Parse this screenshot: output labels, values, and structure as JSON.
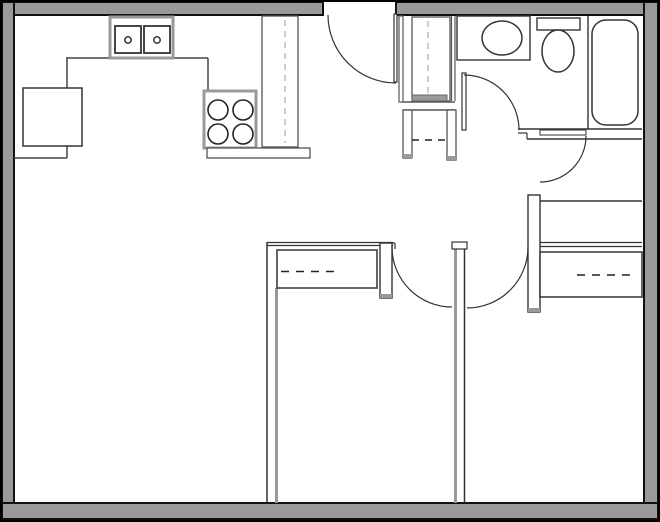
{
  "canvas": {
    "width": 660,
    "height": 522,
    "background": "#ffffff"
  },
  "colors": {
    "wall_fill": "#9a9a9a",
    "wall_edge": "#111111",
    "line_dark": "#2a2a2a",
    "line_mid": "#555555",
    "line_gray": "#999999",
    "dash_light": "#b0b0b0",
    "dash_dark": "#222222",
    "white": "#ffffff"
  },
  "frame": {
    "name": "outer-border",
    "x": 1,
    "y": 1,
    "w": 658,
    "h": 520,
    "stroke": "#000000",
    "sw": 2
  },
  "walls": [
    {
      "name": "wall-top-left-of-entry-door",
      "x": 2,
      "y": 2,
      "w": 321,
      "h": 13
    },
    {
      "name": "wall-top-right-of-entry-door",
      "x": 396,
      "y": 2,
      "w": 262,
      "h": 13
    },
    {
      "name": "wall-left",
      "x": 2,
      "y": 2,
      "w": 12,
      "h": 518
    },
    {
      "name": "wall-right",
      "x": 644,
      "y": 2,
      "w": 14,
      "h": 518
    },
    {
      "name": "wall-bottom",
      "x": 2,
      "y": 503,
      "w": 656,
      "h": 16
    }
  ],
  "lines": [
    {
      "name": "kitchen-counter-left-front-upper",
      "x1": 67,
      "y1": 57,
      "x2": 67,
      "y2": 88,
      "stroke": "#444444",
      "sw": 1.5
    },
    {
      "name": "kitchen-counter-left-front-lower",
      "x1": 67,
      "y1": 146,
      "x2": 67,
      "y2": 158,
      "stroke": "#444444",
      "sw": 1.5
    },
    {
      "name": "kitchen-counter-left-endcap",
      "x1": 14,
      "y1": 158,
      "x2": 67,
      "y2": 158,
      "stroke": "#444444",
      "sw": 1.5
    },
    {
      "name": "kitchen-counter-top-front-a",
      "x1": 67,
      "y1": 58,
      "x2": 110,
      "y2": 58,
      "stroke": "#444444",
      "sw": 1.5
    },
    {
      "name": "kitchen-counter-top-front-b",
      "x1": 173,
      "y1": 58,
      "x2": 208,
      "y2": 58,
      "stroke": "#444444",
      "sw": 1.5
    },
    {
      "name": "kitchen-counter-step",
      "x1": 208,
      "y1": 58,
      "x2": 208,
      "y2": 91,
      "stroke": "#444444",
      "sw": 1.5
    },
    {
      "name": "pantry-cabinet-inner-edge",
      "x1": 266,
      "y1": 16,
      "x2": 266,
      "y2": 147,
      "stroke": "#888888",
      "sw": 1.2
    },
    {
      "name": "entry-closet-inner-left",
      "x1": 416,
      "y1": 17,
      "x2": 416,
      "y2": 95,
      "stroke": "#555555",
      "sw": 1
    },
    {
      "name": "entry-closet-inner-right",
      "x1": 446,
      "y1": 17,
      "x2": 446,
      "y2": 95,
      "stroke": "#555555",
      "sw": 1
    },
    {
      "name": "entry-closet-bottom-line",
      "x1": 403,
      "y1": 102,
      "x2": 455,
      "y2": 102,
      "stroke": "#555555",
      "sw": 1.4
    },
    {
      "name": "hall-closet-top-line",
      "x1": 403,
      "y1": 110,
      "x2": 456,
      "y2": 110,
      "stroke": "#555555",
      "sw": 1.4
    },
    {
      "name": "bathroom-west-wall-a",
      "x1": 451.5,
      "y1": 16,
      "x2": 451.5,
      "y2": 101,
      "stroke": "#555555",
      "sw": 1.2
    },
    {
      "name": "bathroom-west-wall-b",
      "x1": 455,
      "y1": 16,
      "x2": 455,
      "y2": 101,
      "stroke": "#555555",
      "sw": 1.2
    },
    {
      "name": "vanity-divider",
      "x1": 472,
      "y1": 16,
      "x2": 472,
      "y2": 60,
      "stroke": "#333333",
      "sw": 1.3
    },
    {
      "name": "tub-alcove-edge",
      "x1": 588,
      "y1": 16,
      "x2": 588,
      "y2": 129,
      "stroke": "#333333",
      "sw": 1.4
    },
    {
      "name": "bathroom-south-wall-top",
      "x1": 518,
      "y1": 129,
      "x2": 642,
      "y2": 129,
      "stroke": "#333333",
      "sw": 1.5
    },
    {
      "name": "bathroom-south-jamb-h",
      "x1": 518,
      "y1": 133,
      "x2": 527,
      "y2": 133,
      "stroke": "#333333",
      "sw": 1.2
    },
    {
      "name": "bathroom-south-jamb-v",
      "x1": 527,
      "y1": 133,
      "x2": 527,
      "y2": 139,
      "stroke": "#333333",
      "sw": 1.2
    },
    {
      "name": "bathroom-south-wall-bottom",
      "x1": 527,
      "y1": 139,
      "x2": 642,
      "y2": 139,
      "stroke": "#333333",
      "sw": 1.5
    },
    {
      "name": "bedroom2-north-wall",
      "x1": 540,
      "y1": 201,
      "x2": 642,
      "y2": 201,
      "stroke": "#333333",
      "sw": 1.6
    },
    {
      "name": "bedroom2-closet-header-a",
      "x1": 540,
      "y1": 242.5,
      "x2": 642,
      "y2": 242.5,
      "stroke": "#333333",
      "sw": 1.2
    },
    {
      "name": "bedroom2-closet-header-b",
      "x1": 540,
      "y1": 246.5,
      "x2": 642,
      "y2": 246.5,
      "stroke": "#333333",
      "sw": 1.2
    },
    {
      "name": "bedroom1-north-wall-a",
      "x1": 267,
      "y1": 242.5,
      "x2": 393,
      "y2": 242.5,
      "stroke": "#333333",
      "sw": 1.2
    },
    {
      "name": "bedroom1-north-wall-b",
      "x1": 267,
      "y1": 245.5,
      "x2": 393,
      "y2": 245.5,
      "stroke": "#333333",
      "sw": 1.2
    },
    {
      "name": "bedroom1-west-wall-black",
      "x1": 267,
      "y1": 242,
      "x2": 267,
      "y2": 503,
      "stroke": "#333333",
      "sw": 1.5
    },
    {
      "name": "bedroom1-west-wall-gray",
      "x1": 276.5,
      "y1": 288,
      "x2": 276.5,
      "y2": 503,
      "stroke": "#999999",
      "sw": 3
    },
    {
      "name": "bedroom1-door-jamb-a",
      "x1": 392,
      "y1": 243,
      "x2": 395,
      "y2": 243,
      "stroke": "#333333",
      "sw": 1.2
    },
    {
      "name": "bedroom1-door-jamb-b",
      "x1": 395,
      "y1": 243,
      "x2": 395,
      "y2": 249,
      "stroke": "#333333",
      "sw": 1.2
    },
    {
      "name": "center-wall-gray-edge",
      "x1": 455.5,
      "y1": 249,
      "x2": 455.5,
      "y2": 503,
      "stroke": "#999999",
      "sw": 3
    },
    {
      "name": "center-wall-black-edge",
      "x1": 464.5,
      "y1": 246,
      "x2": 464.5,
      "y2": 503,
      "stroke": "#333333",
      "sw": 1.5
    },
    {
      "name": "bedroom1-closet-divider",
      "x1": 341,
      "y1": 250,
      "x2": 341,
      "y2": 288,
      "stroke": "#333333",
      "sw": 1.3
    },
    {
      "name": "bedroom2-closet-divider",
      "x1": 572,
      "y1": 252,
      "x2": 572,
      "y2": 297,
      "stroke": "#333333",
      "sw": 1.3
    }
  ],
  "rects": [
    {
      "name": "fridge",
      "x": 23,
      "y": 88,
      "w": 59,
      "h": 58,
      "fill": "#ffffff",
      "stroke": "#333333",
      "sw": 1.5
    },
    {
      "name": "kitchen-sink-unit",
      "x": 110,
      "y": 17,
      "w": 63,
      "h": 41,
      "fill": "#ffffff",
      "stroke": "#999999",
      "sw": 3
    },
    {
      "name": "kitchen-sink-basin-left",
      "x": 115,
      "y": 26,
      "w": 26,
      "h": 27,
      "fill": "#ffffff",
      "stroke": "#333333",
      "sw": 1.8
    },
    {
      "name": "kitchen-sink-basin-right",
      "x": 144,
      "y": 26,
      "w": 26,
      "h": 27,
      "fill": "#ffffff",
      "stroke": "#333333",
      "sw": 1.8
    },
    {
      "name": "stove",
      "x": 204,
      "y": 91,
      "w": 52,
      "h": 57,
      "fill": "#ffffff",
      "stroke": "#999999",
      "sw": 3
    },
    {
      "name": "kitchen-counter-end-bar",
      "x": 207,
      "y": 148,
      "w": 103,
      "h": 10,
      "fill": "#ffffff",
      "stroke": "#555555",
      "sw": 1.3
    },
    {
      "name": "pantry-cabinet",
      "x": 262,
      "y": 16,
      "w": 36,
      "h": 131,
      "fill": "#ffffff",
      "stroke": "#555555",
      "sw": 1.3
    },
    {
      "name": "entry-door-leaf",
      "x": 394,
      "y": 14,
      "w": 3,
      "h": 68,
      "fill": "#ffffff",
      "stroke": "#333333",
      "sw": 1.2
    },
    {
      "name": "entry-hall-wall",
      "x": 399,
      "y": 16,
      "w": 4,
      "h": 86,
      "fill": "#ffffff",
      "stroke": "#555555",
      "sw": 1.2
    },
    {
      "name": "entry-closet-box",
      "x": 412,
      "y": 17,
      "w": 38,
      "h": 84,
      "fill": "#ffffff",
      "stroke": "#555555",
      "sw": 1.3
    },
    {
      "name": "entry-closet-base-band",
      "x": 412,
      "y": 95,
      "w": 35,
      "h": 6,
      "fill": "#9a9a9a",
      "stroke": "#666666",
      "sw": 1
    },
    {
      "name": "hall-closet-leg-left",
      "x": 403,
      "y": 110,
      "w": 9,
      "h": 48,
      "fill": "#ffffff",
      "stroke": "#555555",
      "sw": 1.3
    },
    {
      "name": "hall-closet-leg-left-tip",
      "x": 403,
      "y": 154,
      "w": 9,
      "h": 4,
      "fill": "#9a9a9a",
      "stroke": "none",
      "sw": 0
    },
    {
      "name": "hall-closet-leg-right",
      "x": 447,
      "y": 110,
      "w": 9,
      "h": 50,
      "fill": "#ffffff",
      "stroke": "#555555",
      "sw": 1.3
    },
    {
      "name": "hall-closet-leg-right-tip",
      "x": 447,
      "y": 156,
      "w": 9,
      "h": 4,
      "fill": "#9a9a9a",
      "stroke": "none",
      "sw": 0
    },
    {
      "name": "bathroom-vanity",
      "x": 457,
      "y": 16,
      "w": 73,
      "h": 44,
      "fill": "#ffffff",
      "stroke": "#333333",
      "sw": 1.4
    },
    {
      "name": "toilet-tank",
      "x": 537,
      "y": 18,
      "w": 43,
      "h": 12,
      "fill": "#ffffff",
      "stroke": "#333333",
      "sw": 1.4
    },
    {
      "name": "bathtub",
      "x": 592,
      "y": 20,
      "w": 46,
      "h": 105,
      "rx": 14,
      "fill": "#ffffff",
      "stroke": "#333333",
      "sw": 1.5
    },
    {
      "name": "bathroom-door-leaf",
      "x": 462,
      "y": 73,
      "w": 4,
      "h": 57,
      "fill": "#ffffff",
      "stroke": "#333333",
      "sw": 1.2
    },
    {
      "name": "bedroom2-entry-door-leaf",
      "x": 540,
      "y": 130,
      "w": 46,
      "h": 5,
      "fill": "#ffffff",
      "stroke": "#333333",
      "sw": 1
    },
    {
      "name": "hall-wing-wall-left",
      "x": 380,
      "y": 243,
      "w": 12,
      "h": 55,
      "fill": "#ffffff",
      "stroke": "#333333",
      "sw": 1.4
    },
    {
      "name": "hall-wing-wall-left-tip",
      "x": 380,
      "y": 294,
      "w": 12,
      "h": 4,
      "fill": "#9a9a9a",
      "stroke": "none",
      "sw": 0
    },
    {
      "name": "bedroom1-closet-box",
      "x": 277,
      "y": 250,
      "w": 100,
      "h": 38,
      "fill": "#ffffff",
      "stroke": "#333333",
      "sw": 1.5
    },
    {
      "name": "center-wall-cap",
      "x": 452,
      "y": 242,
      "w": 15,
      "h": 7,
      "fill": "#ffffff",
      "stroke": "#333333",
      "sw": 1.2
    },
    {
      "name": "hall-wing-wall-right",
      "x": 528,
      "y": 195,
      "w": 12,
      "h": 117,
      "fill": "#ffffff",
      "stroke": "#333333",
      "sw": 1.4
    },
    {
      "name": "hall-wing-wall-right-tip",
      "x": 528,
      "y": 308,
      "w": 12,
      "h": 4,
      "fill": "#9a9a9a",
      "stroke": "none",
      "sw": 0
    },
    {
      "name": "bedroom2-closet-box",
      "x": 540,
      "y": 252,
      "w": 102,
      "h": 45,
      "fill": "#ffffff",
      "stroke": "#333333",
      "sw": 1.5
    }
  ],
  "dashes": [
    {
      "name": "pantry-cabinet-dash",
      "x1": 285,
      "y1": 20,
      "x2": 285,
      "y2": 143,
      "stroke": "#b0b0b0",
      "sw": 1.3,
      "dash": "6,5"
    },
    {
      "name": "entry-closet-rod-dash",
      "x1": 428,
      "y1": 21,
      "x2": 428,
      "y2": 93,
      "stroke": "#b0b0b0",
      "sw": 1.3,
      "dash": "6,5"
    },
    {
      "name": "hall-closet-shelf-dash",
      "x1": 412,
      "y1": 140,
      "x2": 445,
      "y2": 140,
      "stroke": "#222222",
      "sw": 1.6,
      "dash": "7,6"
    },
    {
      "name": "bedroom1-closet-rod-dash",
      "x1": 281,
      "y1": 271.5,
      "x2": 338,
      "y2": 271.5,
      "stroke": "#222222",
      "sw": 1.6,
      "dash": "8,7"
    },
    {
      "name": "bedroom2-closet-rod-dash",
      "x1": 577,
      "y1": 275,
      "x2": 637,
      "y2": 275,
      "stroke": "#222222",
      "sw": 1.6,
      "dash": "8,7"
    }
  ],
  "circles": [
    {
      "name": "stove-burner-tl",
      "cx": 218,
      "cy": 110,
      "r": 10,
      "stroke": "#222222",
      "sw": 1.6
    },
    {
      "name": "stove-burner-tr",
      "cx": 243,
      "cy": 110,
      "r": 10,
      "stroke": "#222222",
      "sw": 1.6
    },
    {
      "name": "stove-burner-bl",
      "cx": 218,
      "cy": 134,
      "r": 10,
      "stroke": "#222222",
      "sw": 1.6
    },
    {
      "name": "stove-burner-br",
      "cx": 243,
      "cy": 134,
      "r": 10,
      "stroke": "#222222",
      "sw": 1.6
    },
    {
      "name": "sink-drain-left",
      "cx": 128,
      "cy": 40,
      "r": 3.2,
      "stroke": "#333333",
      "sw": 1.5
    },
    {
      "name": "sink-drain-right",
      "cx": 157,
      "cy": 40,
      "r": 3.2,
      "stroke": "#333333",
      "sw": 1.5
    }
  ],
  "ellipses": [
    {
      "name": "vanity-sink-oval",
      "cx": 502,
      "cy": 38,
      "rx": 20,
      "ry": 17,
      "stroke": "#333333",
      "sw": 1.5
    },
    {
      "name": "toilet-bowl",
      "cx": 558,
      "cy": 51,
      "rx": 16,
      "ry": 21,
      "stroke": "#333333",
      "sw": 1.5
    }
  ],
  "arcs": [
    {
      "name": "entry-door-swing-arc",
      "d": "M 328,15 A 68,68 0 0 0 396,83",
      "stroke": "#333333",
      "sw": 1.2
    },
    {
      "name": "bathroom-door-swing-arc",
      "d": "M 464,75 A 55,55 0 0 1 519,130",
      "stroke": "#333333",
      "sw": 1.2
    },
    {
      "name": "bedroom2-entry-door-swing-arc",
      "d": "M 586,136 A 46,46 0 0 1 540,182",
      "stroke": "#333333",
      "sw": 1.2
    },
    {
      "name": "bedroom1-door-swing-arc",
      "d": "M 392,247 A 60,60 0 0 0 452,307",
      "stroke": "#333333",
      "sw": 1.2
    },
    {
      "name": "bedroom2-door-swing-arc",
      "d": "M 528,247 A 61,61 0 0 1 467,308",
      "stroke": "#333333",
      "sw": 1.2
    }
  ]
}
